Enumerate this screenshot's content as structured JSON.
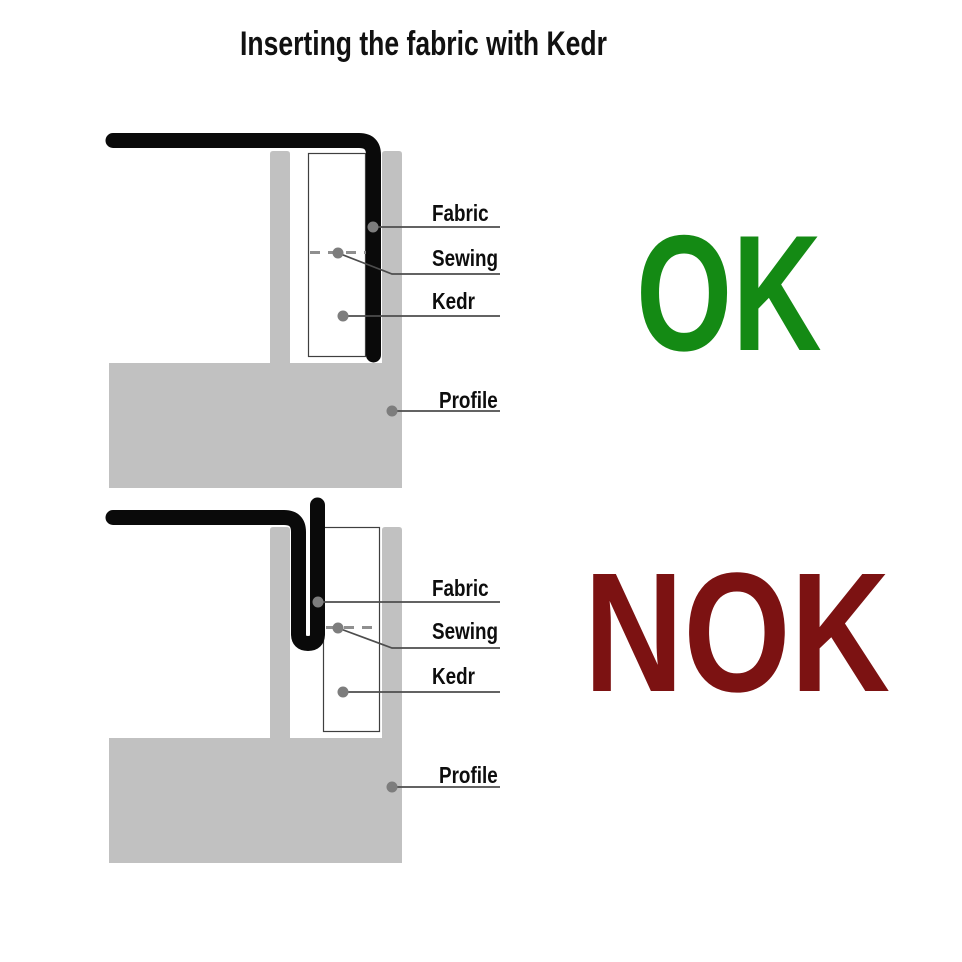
{
  "title": "Inserting the fabric with Kedr",
  "colors": {
    "profile_gray": "#c1c1c1",
    "fabric_black": "#0a0a0a",
    "ok_green": "#148a14",
    "nok_red": "#7c1212",
    "leader_line": "#4d4d4d",
    "marker_dot": "#7d7d7d",
    "sewing_dash": "#8f8f8f",
    "kedr_outline": "#3f3f3f",
    "text": "#111111"
  },
  "ok_diagram": {
    "verdict": "OK",
    "labels": {
      "fabric": "Fabric",
      "sewing": "Sewing",
      "kedr": "Kedr",
      "profile": "Profile"
    }
  },
  "nok_diagram": {
    "verdict": "NOK",
    "labels": {
      "fabric": "Fabric",
      "sewing": "Sewing",
      "kedr": "Kedr",
      "profile": "Profile"
    }
  }
}
